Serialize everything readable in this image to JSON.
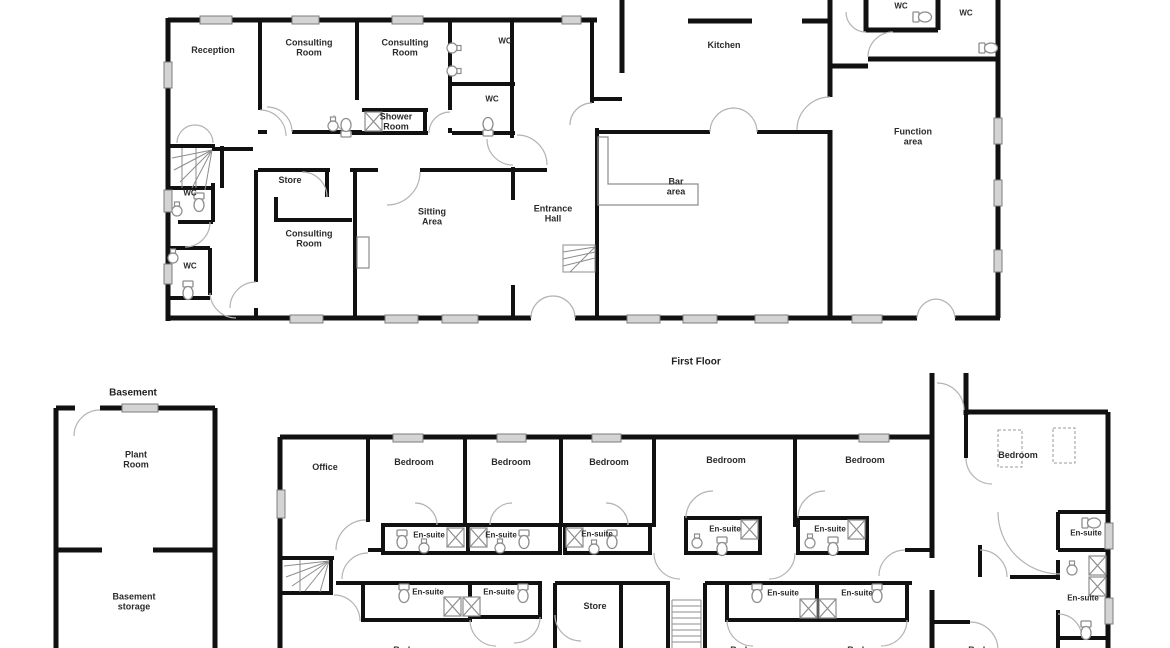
{
  "document": {
    "kind": "architectural floor plan"
  },
  "first_floor": {
    "title": "First Floor",
    "rooms": [
      "Reception",
      "Consulting Room",
      "Consulting Room",
      "WC",
      "WC",
      "Shower Room",
      "Store",
      "Consulting Room",
      "Sitting Area",
      "Entrance Hall",
      "WC",
      "WC",
      "Kitchen",
      "Bar area",
      "WC",
      "WC",
      "Function area"
    ]
  },
  "basement": {
    "title": "Basement",
    "rooms": [
      "Plant Room",
      "Basement storage"
    ]
  },
  "ground_floor": {
    "rooms": [
      "Office",
      "Bedroom",
      "Bedroom",
      "Bedroom",
      "Bedroom",
      "Bedroom",
      "Bedroom",
      "En-suite",
      "En-suite",
      "En-suite",
      "En-suite",
      "En-suite",
      "En-suite",
      "En-suite",
      "En-suite",
      "En-suite",
      "En-suite",
      "En-suite",
      "Store",
      "Bedroom",
      "Bedroom",
      "Bedroom",
      "Bedroom"
    ]
  },
  "style": {
    "wall_color": "#111111",
    "window_fill": "#d4d4d4",
    "door_arc_color": "#b3b3b3",
    "fixture_color": "#8d8d8d",
    "label_color": "#2b2b2b",
    "background": "#ffffff"
  }
}
